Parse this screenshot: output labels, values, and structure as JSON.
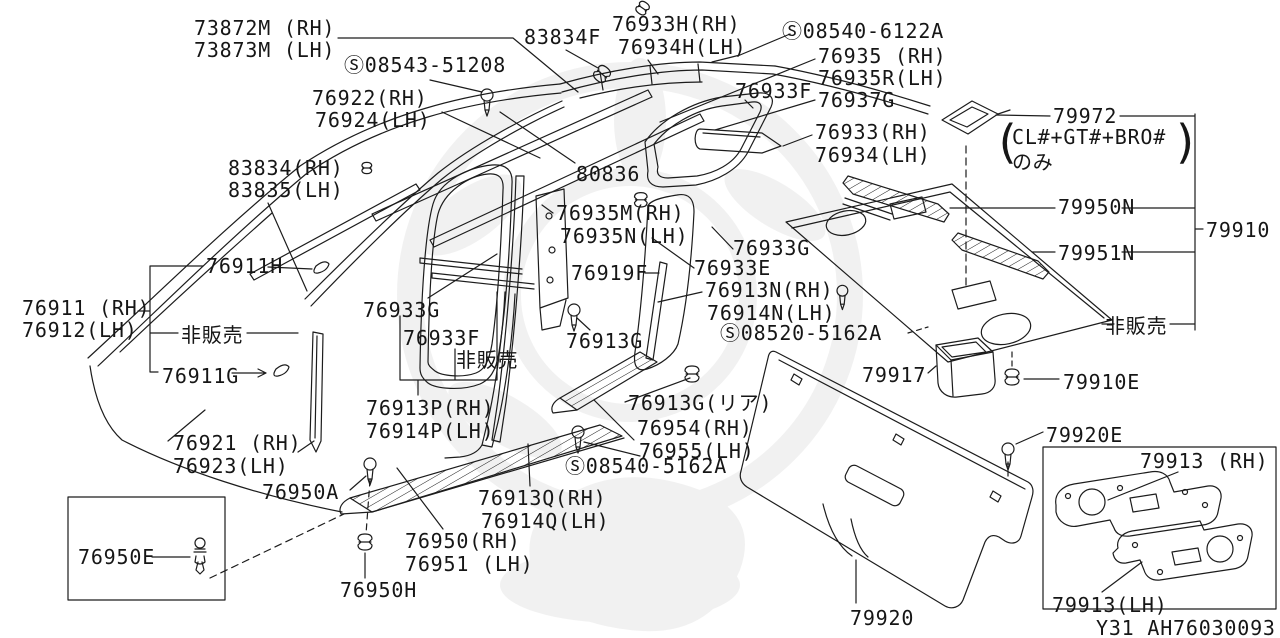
{
  "colors": {
    "line": "#1c1c1c",
    "background": "#ffffff",
    "watermark": "#e7e7e7",
    "text": "#161616"
  },
  "footer": {
    "drawing_code": "Y31 AH76030093"
  },
  "part_labels": [
    {
      "text": "73872M (RH)",
      "x": 194,
      "y": 17
    },
    {
      "text": "73873M (LH)",
      "x": 194,
      "y": 39
    },
    {
      "text": "Ⓢ08543-51208",
      "x": 344,
      "y": 54
    },
    {
      "text": "83834F",
      "x": 524,
      "y": 26
    },
    {
      "text": "76933H(RH)",
      "x": 612,
      "y": 13
    },
    {
      "text": "76934H(LH)",
      "x": 618,
      "y": 36
    },
    {
      "text": "Ⓢ08540-6122A",
      "x": 782,
      "y": 20
    },
    {
      "text": "76935 (RH)",
      "x": 818,
      "y": 45
    },
    {
      "text": "76935R(LH)",
      "x": 818,
      "y": 67
    },
    {
      "text": "76933F",
      "x": 735,
      "y": 80
    },
    {
      "text": "76937G",
      "x": 818,
      "y": 89
    },
    {
      "text": "76922(RH)",
      "x": 312,
      "y": 87
    },
    {
      "text": "76924(LH)",
      "x": 315,
      "y": 109
    },
    {
      "text": "76933(RH)",
      "x": 815,
      "y": 121
    },
    {
      "text": "76934(LH)",
      "x": 815,
      "y": 144
    },
    {
      "text": "79972",
      "x": 1053,
      "y": 105
    },
    {
      "text": "(",
      "x": 993,
      "y": 118,
      "cls": "paren"
    },
    {
      "text": "CL#+GT#+BRO#",
      "x": 1012,
      "y": 126
    },
    {
      "text": "のみ",
      "x": 1012,
      "y": 151
    },
    {
      "text": ")",
      "x": 1172,
      "y": 118,
      "cls": "paren"
    },
    {
      "text": "83834(RH)",
      "x": 228,
      "y": 157
    },
    {
      "text": "83835(LH)",
      "x": 228,
      "y": 179
    },
    {
      "text": "80836",
      "x": 576,
      "y": 163
    },
    {
      "text": "79950N",
      "x": 1058,
      "y": 196
    },
    {
      "text": "79910",
      "x": 1206,
      "y": 219
    },
    {
      "text": "76935M(RH)",
      "x": 556,
      "y": 202
    },
    {
      "text": "76935N(LH)",
      "x": 560,
      "y": 225
    },
    {
      "text": "79951N",
      "x": 1058,
      "y": 242
    },
    {
      "text": "76911H",
      "x": 206,
      "y": 255
    },
    {
      "text": "76933G",
      "x": 733,
      "y": 237
    },
    {
      "text": "76933E",
      "x": 694,
      "y": 257
    },
    {
      "text": "76911 (RH)",
      "x": 22,
      "y": 297
    },
    {
      "text": "76912(LH)",
      "x": 22,
      "y": 319
    },
    {
      "text": "76919F",
      "x": 571,
      "y": 262
    },
    {
      "text": "76913N(RH)",
      "x": 705,
      "y": 279
    },
    {
      "text": "76914N(LH)",
      "x": 707,
      "y": 302
    },
    {
      "text": "非販売",
      "x": 181,
      "y": 324
    },
    {
      "text": "76933G",
      "x": 363,
      "y": 299
    },
    {
      "text": "Ⓢ08520-5162A",
      "x": 720,
      "y": 322
    },
    {
      "text": "76933F",
      "x": 403,
      "y": 327
    },
    {
      "text": "非販売",
      "x": 456,
      "y": 349
    },
    {
      "text": "76913G",
      "x": 566,
      "y": 330
    },
    {
      "text": "非販売",
      "x": 1105,
      "y": 315
    },
    {
      "text": "76911G",
      "x": 162,
      "y": 365
    },
    {
      "text": "79917",
      "x": 862,
      "y": 364
    },
    {
      "text": "79910E",
      "x": 1063,
      "y": 371
    },
    {
      "text": "76913P(RH)",
      "x": 366,
      "y": 397
    },
    {
      "text": "76914P(LH)",
      "x": 366,
      "y": 420
    },
    {
      "text": "76913G(リア)",
      "x": 628,
      "y": 392
    },
    {
      "text": "76954(RH)",
      "x": 637,
      "y": 417
    },
    {
      "text": "76955(LH)",
      "x": 639,
      "y": 440
    },
    {
      "text": "76921 (RH)",
      "x": 173,
      "y": 432
    },
    {
      "text": "76923(LH)",
      "x": 173,
      "y": 455
    },
    {
      "text": "Ⓢ08540-5162A",
      "x": 565,
      "y": 455
    },
    {
      "text": "79920E",
      "x": 1046,
      "y": 424
    },
    {
      "text": "79913 (RH)",
      "x": 1140,
      "y": 450
    },
    {
      "text": "76950A",
      "x": 262,
      "y": 481
    },
    {
      "text": "76913Q(RH)",
      "x": 478,
      "y": 487
    },
    {
      "text": "76914Q(LH)",
      "x": 481,
      "y": 510
    },
    {
      "text": "76950E",
      "x": 78,
      "y": 546
    },
    {
      "text": "76950(RH)",
      "x": 405,
      "y": 530
    },
    {
      "text": "76951 (LH)",
      "x": 405,
      "y": 553
    },
    {
      "text": "76950H",
      "x": 340,
      "y": 579
    },
    {
      "text": "79920",
      "x": 850,
      "y": 607
    },
    {
      "text": "79913(LH)",
      "x": 1052,
      "y": 594
    }
  ]
}
